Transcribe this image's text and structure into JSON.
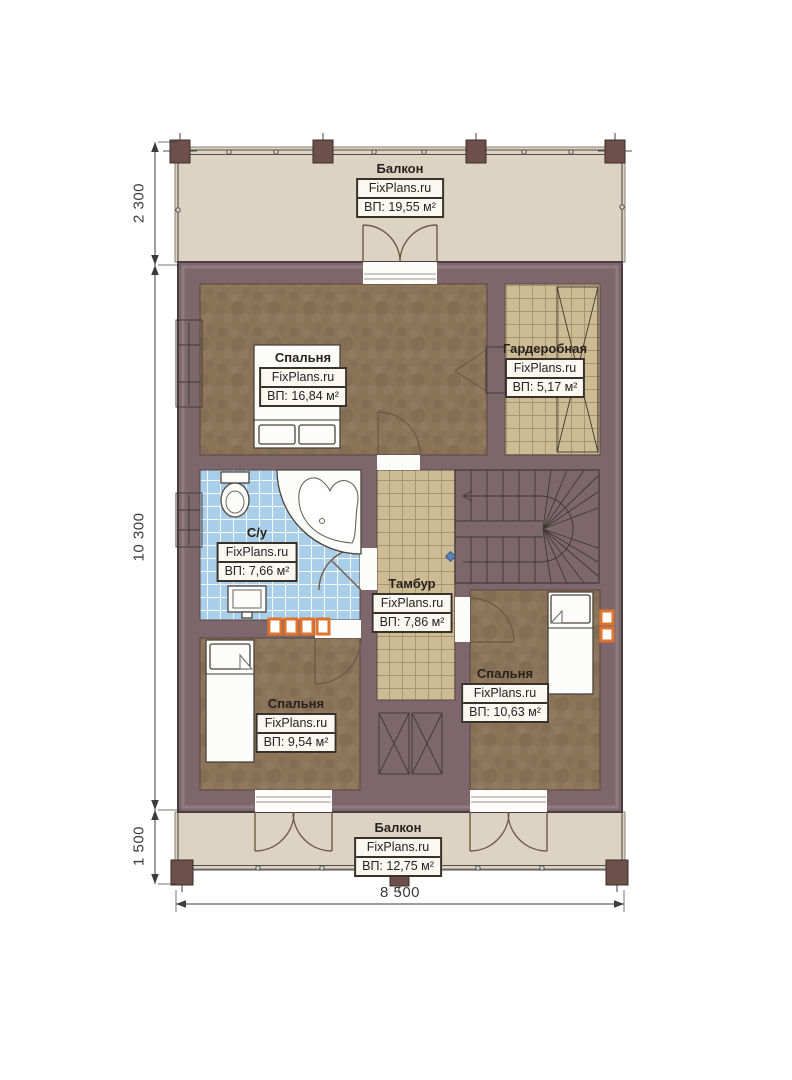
{
  "brand": "FixPlans.ru",
  "rooms": [
    {
      "id": "balcony-top",
      "name": "Балкон",
      "brand": "FixPlans.ru",
      "area": "ВП: 19,55 м²"
    },
    {
      "id": "bedroom-top",
      "name": "Спальня",
      "brand": "FixPlans.ru",
      "area": "ВП: 16,84 м²"
    },
    {
      "id": "wardrobe",
      "name": "Гардеробная",
      "brand": "FixPlans.ru",
      "area": "ВП: 5,17 м²"
    },
    {
      "id": "bathroom",
      "name": "С/у",
      "brand": "FixPlans.ru",
      "area": "ВП: 7,66 м²"
    },
    {
      "id": "tambour",
      "name": "Тамбур",
      "brand": "FixPlans.ru",
      "area": "ВП: 7,86 м²"
    },
    {
      "id": "bedroom-bottom-left",
      "name": "Спальня",
      "brand": "FixPlans.ru",
      "area": "ВП: 9,54 м²"
    },
    {
      "id": "bedroom-bottom-right",
      "name": "Спальня",
      "brand": "FixPlans.ru",
      "area": "ВП: 10,63 м²"
    },
    {
      "id": "balcony-bottom",
      "name": "Балкон",
      "brand": "FixPlans.ru",
      "area": "ВП: 12,75 м²"
    }
  ],
  "dimensions": {
    "top_left": "2 300",
    "middle_left": "10 300",
    "bottom_left": "1 500",
    "bottom": "8 500"
  },
  "colors": {
    "wall": "#7d676d",
    "wallline": "#4c3c41",
    "balcony": "#ddd3c2",
    "brown": "#8b7457",
    "tan": "#cdbb93",
    "blue": "#a9cee9",
    "white": "#fcfcfa",
    "line": "#3d3832",
    "arc": "#6f5a49",
    "orange": "#e0732e",
    "dim": "#3b3b3b",
    "post": "#6d5049",
    "labelbg": "#fbf8f1"
  }
}
